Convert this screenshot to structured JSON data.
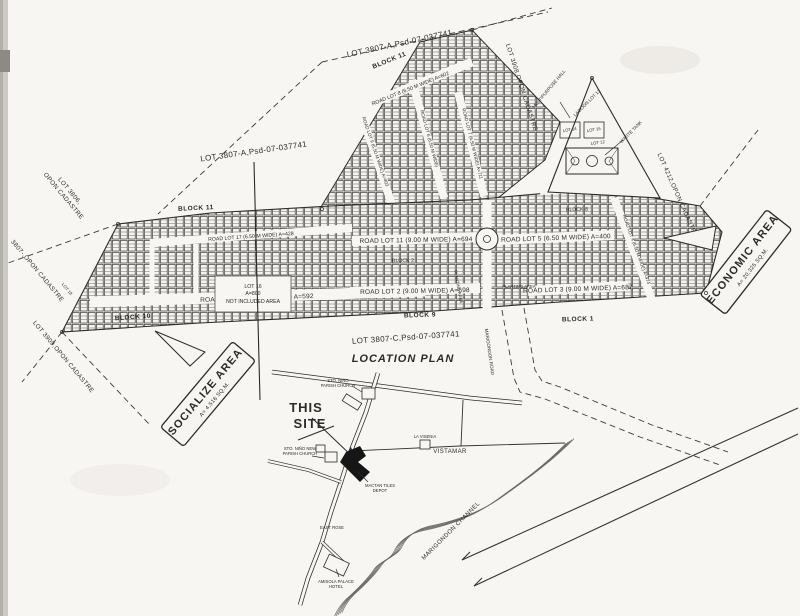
{
  "plan": {
    "title_top": "LOT 3807-A,Psd-07-037741",
    "title_left": "LOT 3807-A,Psd-07-037741",
    "title_bottom": "LOT 3807-C,Psd-07-037741",
    "blocks": {
      "b11_top": "BLOCK 11",
      "b11_left": "BLOCK 11",
      "b10": "BLOCK 10",
      "b9": "BLOCK 9",
      "b2": "BLOCK 2",
      "b8": "BLOCK 8",
      "b1": "BLOCK 1"
    },
    "roads": {
      "r8": "ROAD LOT 8 (6.50 M WIDE) A=602",
      "r9": "ROAD LOT 9 (6.50 M WIDE) A=403",
      "r6": "ROAD LOT 6 (6.50 M WIDE)",
      "r7": "ROAD LOT 7 (6.50 M WIDE) A=711",
      "r17": "ROAD LOT 17 (6.50 M WIDE) A=428",
      "r19": "ROAD LOT 19 (6.50 M WIDE) A=592",
      "r11": "ROAD LOT 11 (9.00 M WIDE) A=694",
      "r5": "ROAD LOT 5 (6.50 M WIDE) A=400",
      "r2": "ROAD LOT 2 (9.00 M WIDE) A=698",
      "r3": "ROAD LOT 3 (9.00 M WIDE) A=687",
      "r4": "ROAD LOT 4 (6.50 M WIDE) A=474",
      "r10_partial": "(6.50 M WIDE) A=462"
    },
    "boundaries": {
      "lot3908": "LOT 3908,OPON CADASTRE",
      "lot4212": "LOT 4212,OPON CADASTRE",
      "lot3806_l1": "LOT 3806,",
      "lot3806_l2": "OPON CADASTRE",
      "lot3807": "3807-,OPON CADASTRE",
      "lot3909": "LOT 3909,OPON CADASTRE"
    },
    "areas": {
      "economic_title": "ECONOMIC AREA",
      "economic_area": "A= 20,325 SQ.M.",
      "socialize_title": "SOCIALIZE AREA",
      "socialize_area": "A= 4,516 SQ.M."
    },
    "lots": {
      "lot16_l1": "LOT 16",
      "lot16_l2": "A=800",
      "lot16_l3": "NOT INCLUDED AREA",
      "lot18": "LOT 18",
      "lagoon": "LAGOON LOT 13",
      "lot14": "LOT 14",
      "lot15": "LOT 15",
      "lot12": "LOT 12"
    },
    "amenities": {
      "hall": "MULTIPURPOSE HALL",
      "waste_tank": "WASTE TANK",
      "planting1": "PLANTING AREA",
      "planting2": "PLANTING AREA"
    }
  },
  "location_plan": {
    "title": "LOCATION PLAN",
    "this_site_l1": "THIS",
    "this_site_l2": "SITE",
    "labels": {
      "church_l1": "STO. NIÑO",
      "church_l2": "PARISH CHURCH",
      "new_church_l1": "STO. NIÑO NEW",
      "new_church_l2": "PARISH CHURCH",
      "depot_l1": "MACTAN TILES",
      "depot_l2": "DEPOT",
      "east_rose": "EAST ROSE",
      "hotel_l1": "AMISOLA PALACE",
      "hotel_l2": "HOTEL",
      "la_visenia": "LA VISENIA",
      "vistamar": "VISTAMAR",
      "channel": "MARIGONDON CHANNEL",
      "marigondon_road": "MARIGONDON ROAD"
    }
  }
}
